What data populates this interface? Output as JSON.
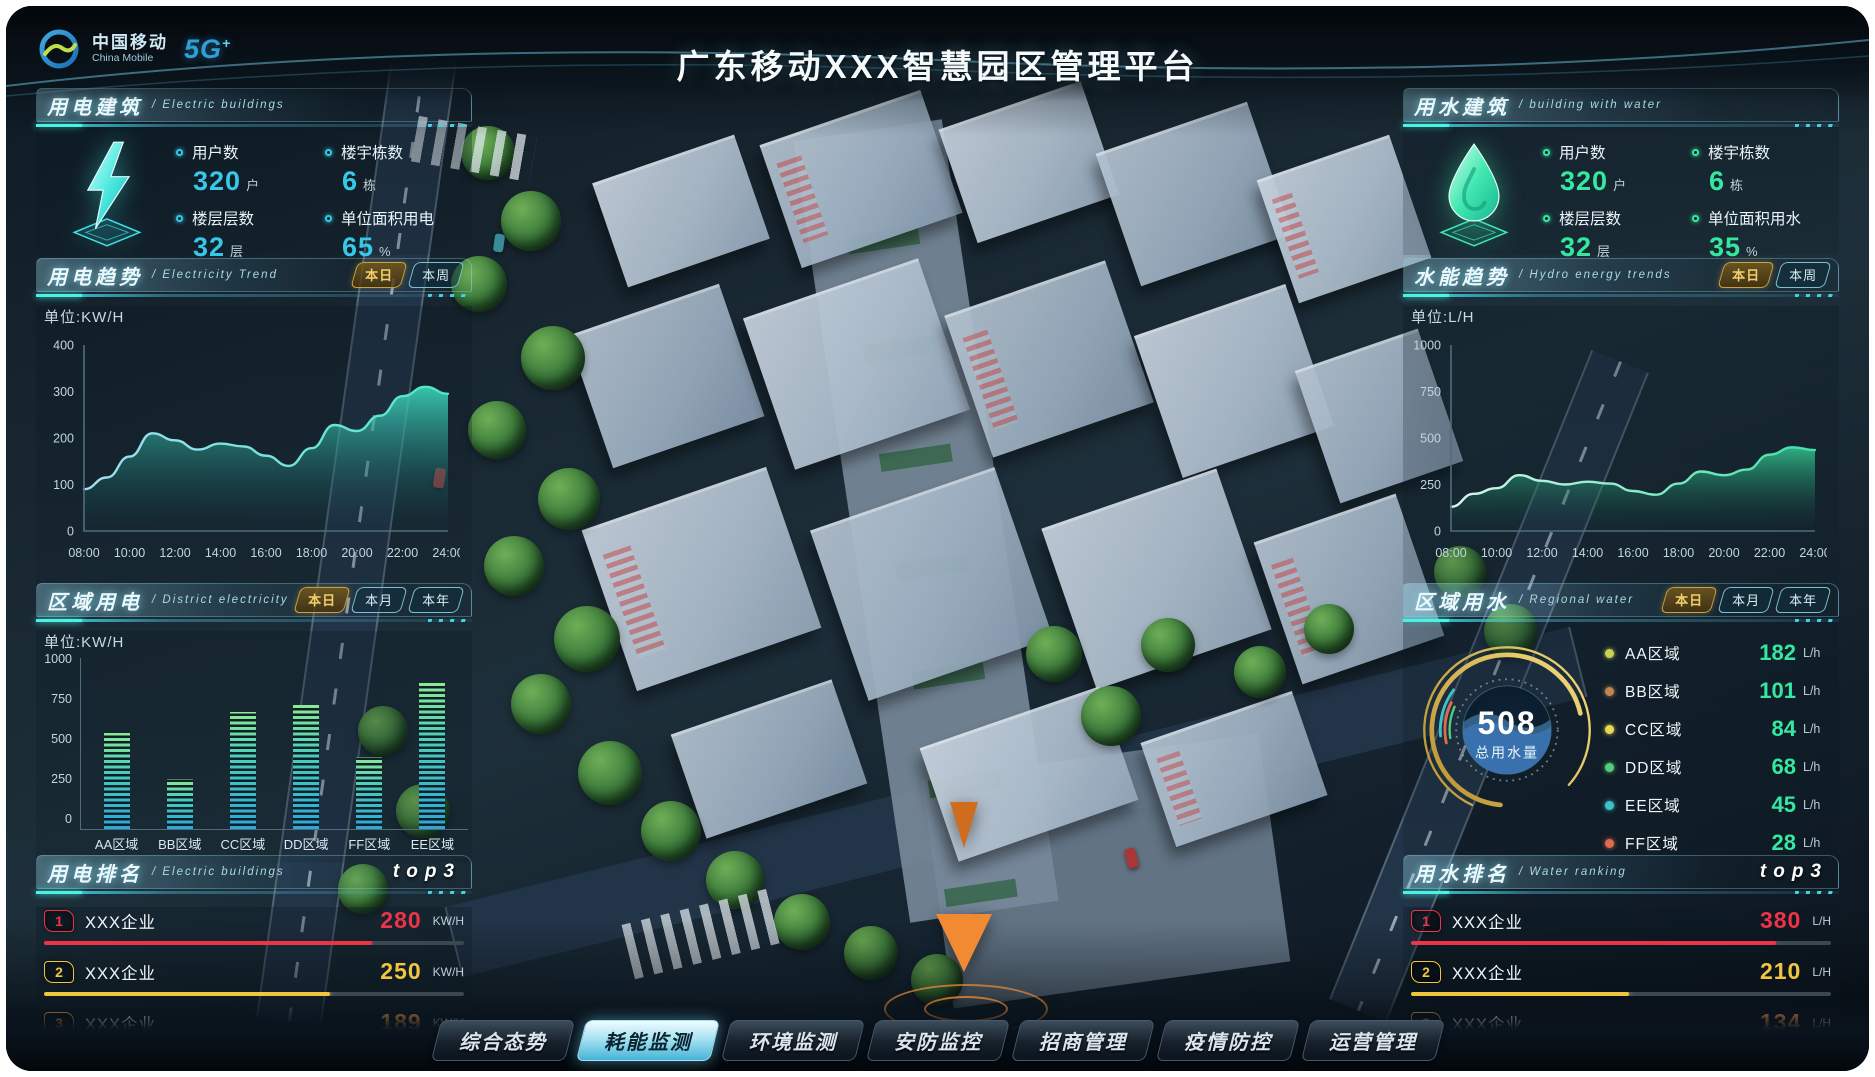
{
  "header": {
    "logo_cn": "中国移动",
    "logo_en": "China Mobile",
    "logo_5g": "5G",
    "logo_5g_plus": "+",
    "title": "广东移动XXX智慧园区管理平台"
  },
  "panels": {
    "electric_building": {
      "title": "用电建筑",
      "subtitle": "Electric buildings",
      "stats": [
        {
          "name": "users",
          "label": "用户数",
          "value": "320",
          "unit": "户"
        },
        {
          "name": "buildings",
          "label": "楼宇栋数",
          "value": "6",
          "unit": "栋"
        },
        {
          "name": "floors",
          "label": "楼层层数",
          "value": "32",
          "unit": "层"
        },
        {
          "name": "unit-area-electricity",
          "label": "单位面积用电",
          "value": "65",
          "unit": "%"
        }
      ]
    },
    "electric_trend": {
      "title": "用电趋势",
      "subtitle": "Electricity Trend",
      "unit_label": "单位:KW/H",
      "tabs": [
        {
          "name": "today",
          "label": "本日",
          "active": true
        },
        {
          "name": "week",
          "label": "本周",
          "active": false
        }
      ]
    },
    "district_electricity": {
      "title": "区域用电",
      "subtitle": "District electricity",
      "unit_label": "单位:KW/H",
      "tabs": [
        {
          "name": "today",
          "label": "本日",
          "active": true
        },
        {
          "name": "month",
          "label": "本月",
          "active": false
        },
        {
          "name": "year",
          "label": "本年",
          "active": false
        }
      ]
    },
    "electric_ranking": {
      "title": "用电排名",
      "subtitle": "Electric buildings",
      "badge": "top3",
      "rows": [
        {
          "rank": "1",
          "name": "XXX企业",
          "value": "280",
          "unit": "KW/H",
          "color": "#ee3346",
          "pct": 78
        },
        {
          "rank": "2",
          "name": "XXX企业",
          "value": "250",
          "unit": "KW/H",
          "color": "#f0c63e",
          "pct": 68
        },
        {
          "rank": "3",
          "name": "XXX企业",
          "value": "189",
          "unit": "KW/H",
          "color": "#f2973c",
          "pct": 53
        }
      ]
    },
    "water_building": {
      "title": "用水建筑",
      "subtitle": "building with water",
      "stats": [
        {
          "name": "users",
          "label": "用户数",
          "value": "320",
          "unit": "户"
        },
        {
          "name": "buildings",
          "label": "楼宇栋数",
          "value": "6",
          "unit": "栋"
        },
        {
          "name": "floors",
          "label": "楼层层数",
          "value": "32",
          "unit": "层"
        },
        {
          "name": "unit-area-water",
          "label": "单位面积用水",
          "value": "35",
          "unit": "%"
        }
      ]
    },
    "water_trend": {
      "title": "水能趋势",
      "subtitle": "Hydro energy trends",
      "unit_label": "单位:L/H",
      "tabs": [
        {
          "name": "today",
          "label": "本日",
          "active": true
        },
        {
          "name": "week",
          "label": "本周",
          "active": false
        }
      ]
    },
    "regional_water": {
      "title": "区域用水",
      "subtitle": "Regional water",
      "tabs": [
        {
          "name": "today",
          "label": "本日",
          "active": true
        },
        {
          "name": "month",
          "label": "本月",
          "active": false
        },
        {
          "name": "year",
          "label": "本年",
          "active": false
        }
      ],
      "gauge": {
        "value": "508",
        "label": "总用水量"
      },
      "legend": [
        {
          "name": "AA区域",
          "value": "182",
          "unit": "L/h",
          "color": "#c7d34f"
        },
        {
          "name": "BB区域",
          "value": "101",
          "unit": "L/h",
          "color": "#c08552"
        },
        {
          "name": "CC区域",
          "value": "84",
          "unit": "L/h",
          "color": "#ead850"
        },
        {
          "name": "DD区域",
          "value": "68",
          "unit": "L/h",
          "color": "#52cd7a"
        },
        {
          "name": "EE区域",
          "value": "45",
          "unit": "L/h",
          "color": "#3ec2c9"
        },
        {
          "name": "FF区域",
          "value": "28",
          "unit": "L/h",
          "color": "#e06a50"
        }
      ]
    },
    "water_ranking": {
      "title": "用水排名",
      "subtitle": "Water ranking",
      "badge": "top3",
      "rows": [
        {
          "rank": "1",
          "name": "XXX企业",
          "value": "380",
          "unit": "L/H",
          "color": "#ee3346",
          "pct": 87
        },
        {
          "rank": "2",
          "name": "XXX企业",
          "value": "210",
          "unit": "L/H",
          "color": "#f0c63e",
          "pct": 52
        },
        {
          "rank": "3",
          "name": "XXX企业",
          "value": "134",
          "unit": "L/H",
          "color": "#f2973c",
          "pct": 32
        }
      ]
    }
  },
  "bottom_nav": [
    {
      "name": "overview",
      "label": "综合态势",
      "active": false
    },
    {
      "name": "energy-monitor",
      "label": "耗能监测",
      "active": true
    },
    {
      "name": "environment-monitor",
      "label": "环境监测",
      "active": false
    },
    {
      "name": "security-monitor",
      "label": "安防监控",
      "active": false
    },
    {
      "name": "investment",
      "label": "招商管理",
      "active": false
    },
    {
      "name": "epidemic-control",
      "label": "疫情防控",
      "active": false
    },
    {
      "name": "operations",
      "label": "运营管理",
      "active": false
    }
  ],
  "chart_data": [
    {
      "id": "electric_trend",
      "type": "area",
      "title": "用电趋势",
      "ylabel": "单位:KW/H",
      "x": [
        "08:00",
        "10:00",
        "12:00",
        "14:00",
        "16:00",
        "18:00",
        "20:00",
        "22:00",
        "24:00"
      ],
      "values": [
        90,
        115,
        160,
        210,
        195,
        175,
        188,
        182,
        162,
        140,
        178,
        228,
        215,
        248,
        290,
        310,
        295
      ],
      "ylim": [
        0,
        400
      ],
      "yticks": [
        0,
        100,
        200,
        300,
        400
      ],
      "color": "#49e0c8"
    },
    {
      "id": "district_electricity",
      "type": "bar",
      "title": "区域用电",
      "ylabel": "单位:KW/H",
      "categories": [
        "AA区域",
        "BB区域",
        "CC区域",
        "DD区域",
        "FF区域",
        "EE区域"
      ],
      "values": [
        560,
        290,
        680,
        720,
        420,
        850
      ],
      "ylim": [
        0,
        1000
      ],
      "yticks": [
        0,
        250,
        500,
        750,
        1000
      ]
    },
    {
      "id": "water_trend",
      "type": "area",
      "title": "水能趋势",
      "ylabel": "单位:L/H",
      "x": [
        "08:00",
        "10:00",
        "12:00",
        "14:00",
        "16:00",
        "18:00",
        "20:00",
        "22:00",
        "24:00"
      ],
      "values": [
        130,
        200,
        230,
        300,
        270,
        250,
        265,
        255,
        215,
        195,
        255,
        320,
        300,
        330,
        410,
        450,
        435
      ],
      "ylim": [
        0,
        1000
      ],
      "yticks": [
        0,
        250,
        500,
        750,
        1000
      ],
      "color": "#3fe0a8"
    },
    {
      "id": "regional_water",
      "type": "gauge",
      "title": "区域用水",
      "value": 508,
      "label": "总用水量",
      "segments": [
        {
          "name": "AA区域",
          "value": 182
        },
        {
          "name": "BB区域",
          "value": 101
        },
        {
          "name": "CC区域",
          "value": 84
        },
        {
          "name": "DD区域",
          "value": 68
        },
        {
          "name": "EE区域",
          "value": 45
        },
        {
          "name": "FF区域",
          "value": 28
        }
      ]
    }
  ]
}
